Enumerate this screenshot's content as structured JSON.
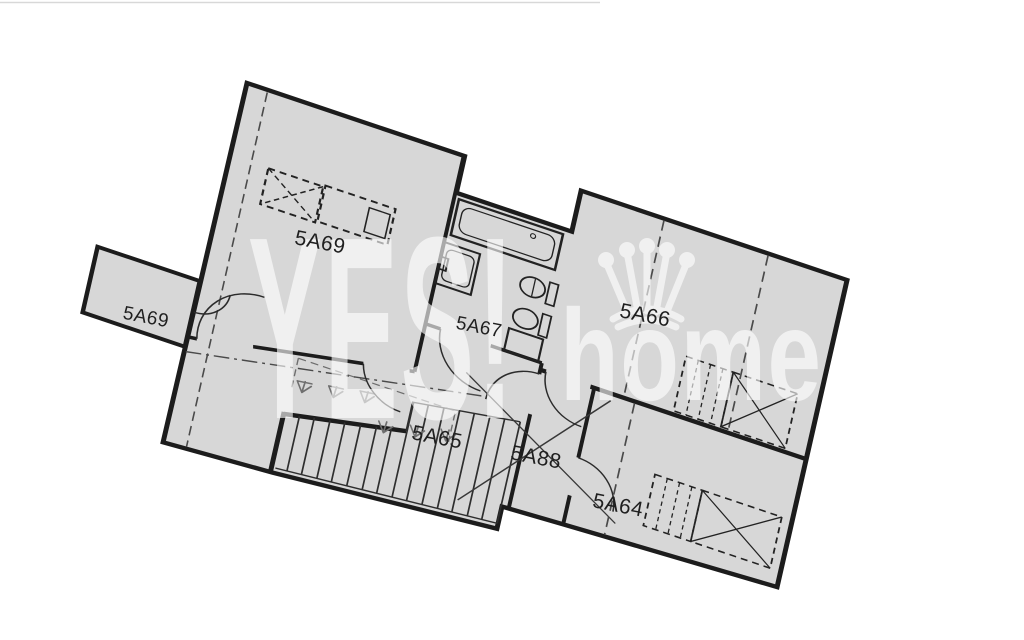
{
  "document": {
    "type": "floor-plan",
    "description": "Scanned upper-floor apartment plan, rotated slightly clockwise"
  },
  "colors": {
    "background": "#ffffff",
    "floor_fill": "#d7d7d7",
    "wall": "#1c1c1c",
    "thin_line": "#2e2e2e",
    "dashed_line": "#4a4a4a",
    "railing_marks": "#6f6f6f",
    "label_text": "#1f1f1f",
    "watermark": "#ffffff",
    "scan_artifact": "#cfcfcf"
  },
  "rooms": [
    {
      "id": "5A69-room",
      "label": "5A69"
    },
    {
      "id": "5A69-balcony",
      "label": "5A69"
    },
    {
      "id": "5A67-bathroom",
      "label": "5A67"
    },
    {
      "id": "5A66-room",
      "label": "5A66"
    },
    {
      "id": "5A65-hall",
      "label": "5A65"
    },
    {
      "id": "5A88-hall",
      "label": "5A88"
    },
    {
      "id": "5A64-room",
      "label": "5A64"
    }
  ],
  "watermark": {
    "brand_text_1": "YES!",
    "brand_text_2": "home",
    "crown_icon": "crown"
  },
  "features": {
    "staircase_treads": 15,
    "bathroom_fixtures": [
      "bathtub",
      "washbasin",
      "toilet",
      "bidet",
      "washing-machine"
    ],
    "furniture_symbols": [
      "dashed wardrobe with X",
      "dashed wardrobe with rails"
    ]
  }
}
